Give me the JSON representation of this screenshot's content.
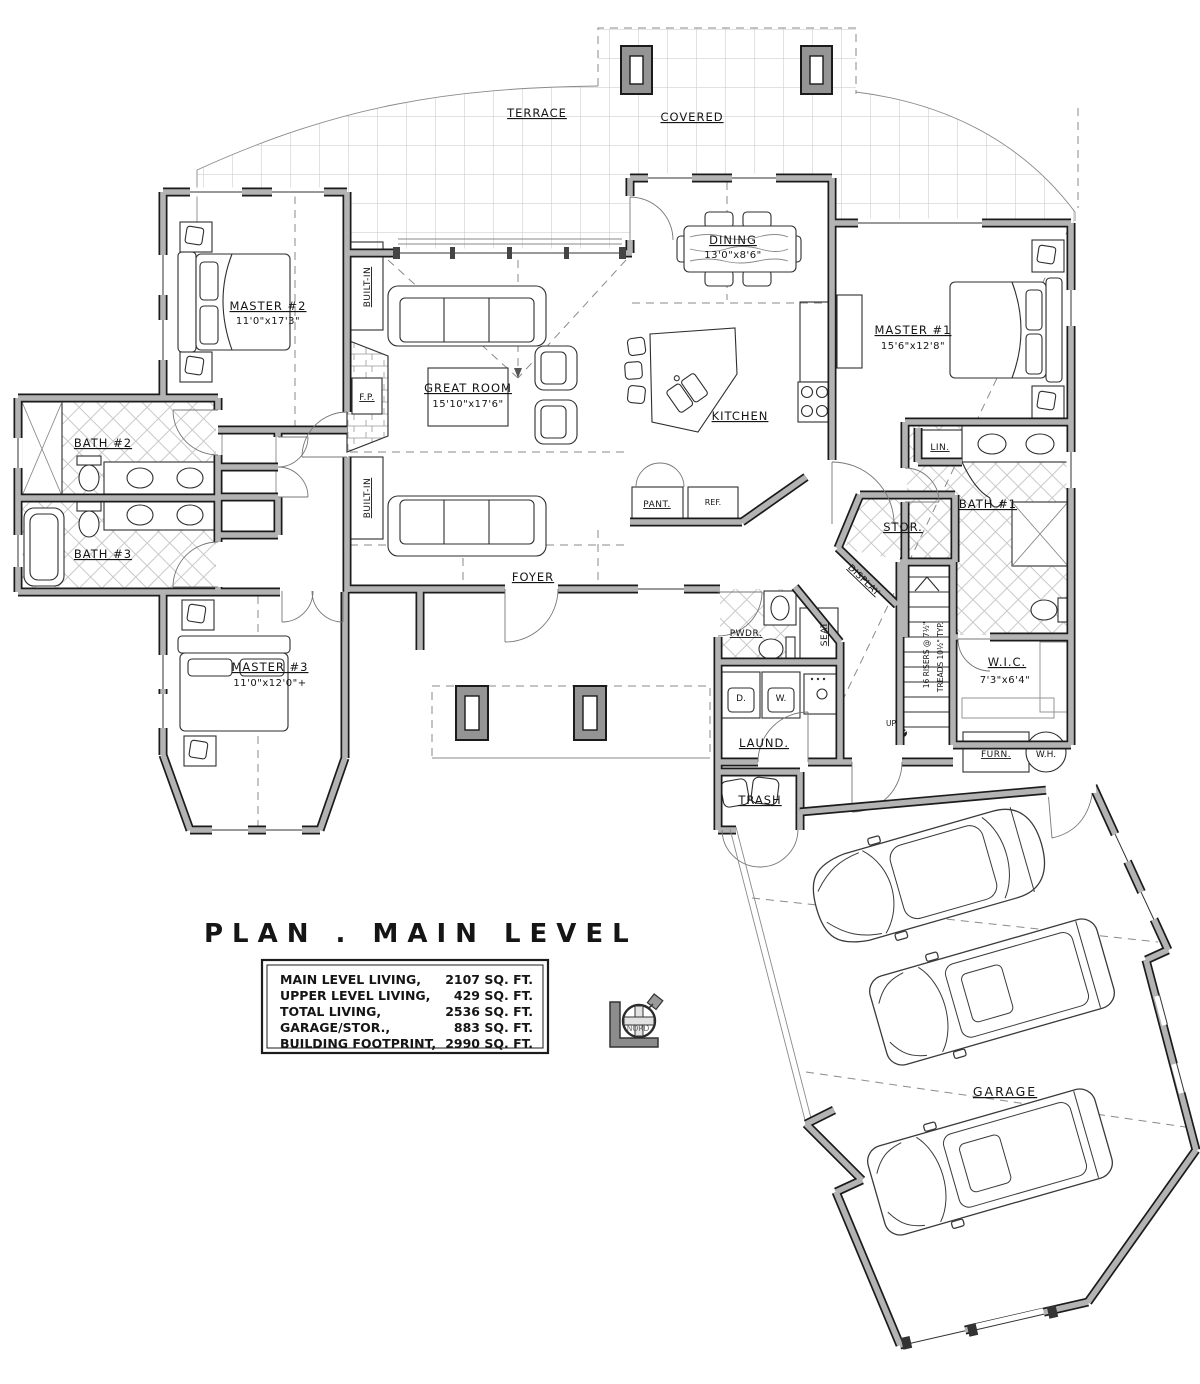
{
  "plan": {
    "title": "PLAN . MAIN LEVEL",
    "areas": {
      "rows": [
        {
          "label": "MAIN LEVEL LIVING,",
          "value": "2107  SQ. FT."
        },
        {
          "label": "UPPER LEVEL LIVING,",
          "value": "429  SQ. FT."
        },
        {
          "label": "TOTAL  LIVING,",
          "value": "2536  SQ. FT."
        },
        {
          "label": "GARAGE/STOR.,",
          "value": "883 SQ. FT."
        },
        {
          "label": "BUILDING FOOTPRINT,",
          "value": "2990  SQ. FT."
        }
      ]
    },
    "rooms": {
      "terrace": "TERRACE",
      "covered": "COVERED",
      "great_room": {
        "name": "GREAT ROOM",
        "dims": "15'10\"x17'6\""
      },
      "dining": {
        "name": "DINING",
        "dims": "13'0\"x8'6\""
      },
      "kitchen": "KITCHEN",
      "master1": {
        "name": "MASTER #1",
        "dims": "15'6\"x12'8\""
      },
      "master2": {
        "name": "MASTER #2",
        "dims": "11'0\"x17'3\""
      },
      "master3": {
        "name": "MASTER #3",
        "dims": "11'0\"x12'0\"+"
      },
      "bath1": "BATH #1",
      "bath2": "BATH #2",
      "bath3": "BATH #3",
      "foyer": "FOYER",
      "wic": {
        "name": "W.I.C.",
        "dims": "7'3\"x6'4\""
      },
      "powder": "PWDR.",
      "laundry": "LAUND.",
      "seat": "SEAT",
      "dryer": "D.",
      "washer": "W.",
      "trash": "TRASH",
      "furnace": "FURN.",
      "water_heater": "W.H.",
      "garage": "GARAGE",
      "storage": "STOR.",
      "linen": "LIN.",
      "pantry": "PANT.",
      "fridge": "REF.",
      "fireplace": "F.P.",
      "built_in": "BUILT-IN",
      "display": "DISPLAY"
    },
    "stairs": {
      "risers": "16 RISERS @ 7½\"",
      "treads": "TREADS 10½\" TYP.",
      "up": "UP"
    },
    "compass": {
      "label": "NORD"
    }
  }
}
